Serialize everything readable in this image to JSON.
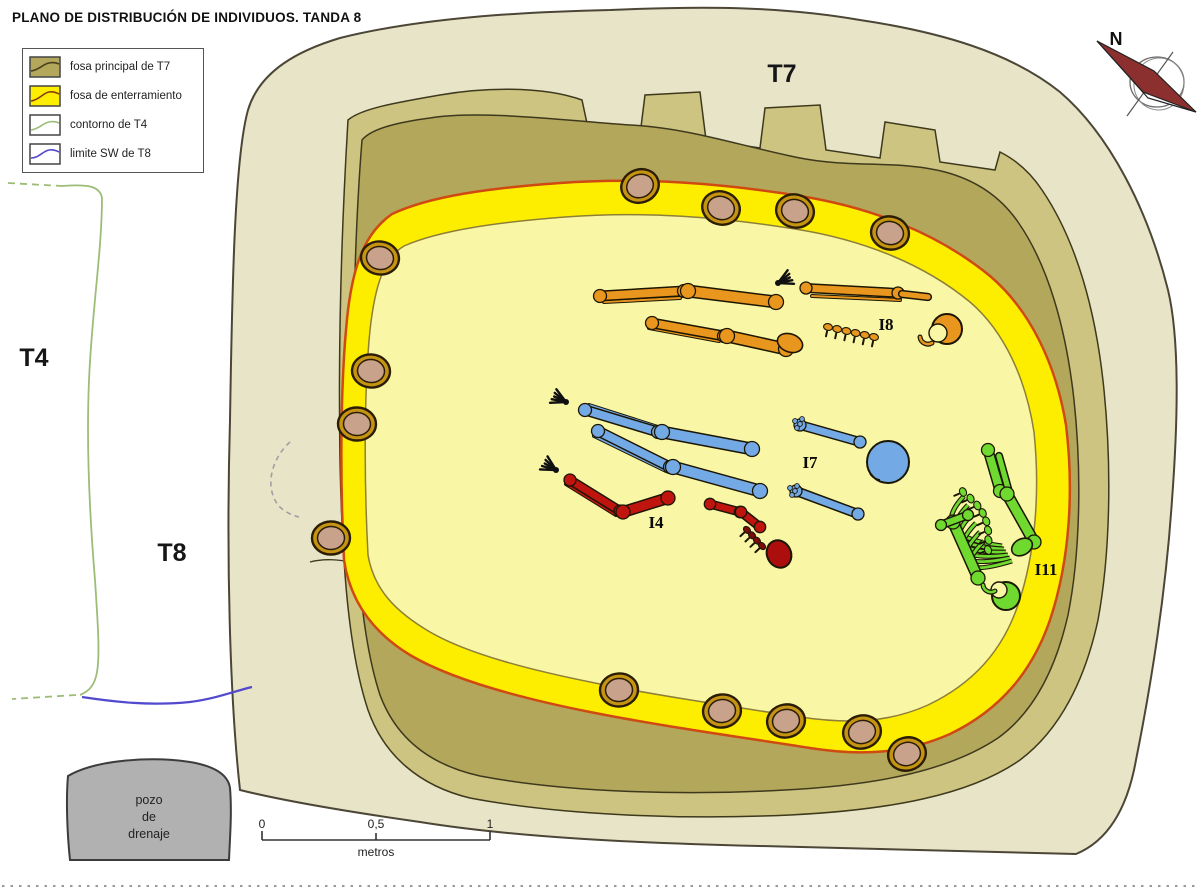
{
  "title": "PLANO DE DISTRIBUCIÓN DE INDIVIDUOS. TANDA 8",
  "legend": {
    "items": [
      {
        "label": "fosa principal de T7",
        "swatch": "olive-area"
      },
      {
        "label": "fosa de enterramiento",
        "swatch": "yellow-area"
      },
      {
        "label": "contorno de T4",
        "swatch": "green-line"
      },
      {
        "label": "limite SW de T8",
        "swatch": "blue-line"
      }
    ]
  },
  "areas": {
    "t7": "T7",
    "t4": "T4",
    "t8": "T8"
  },
  "individuals": [
    {
      "id": "I8",
      "color": "#e8961e"
    },
    {
      "id": "I7",
      "color": "#73a9e4"
    },
    {
      "id": "I4",
      "color": "#c0140f"
    },
    {
      "id": "I11",
      "color": "#6fd930"
    }
  ],
  "compass": {
    "label": "N"
  },
  "drain": {
    "label_lines": [
      "pozo",
      "de",
      "drenaje"
    ]
  },
  "scale_bar": {
    "ticks": [
      "0",
      "0,5",
      "1"
    ],
    "unit": "metros"
  },
  "colors": {
    "outer_area": "#e8e4c8",
    "fosa_principal_outer": "#cdc481",
    "fosa_principal": "#b3a75c",
    "fosa_enterramiento": "#fdee00",
    "fosa_border_red": "#cf4a10",
    "burial_floor": "#f9f7a6",
    "stone_fill": "#c8a28a",
    "stone_ring": "#c59412",
    "contorno_t4_line": "#9dbd77",
    "limite_t8_line": "#5149ce",
    "drain_fill": "#b1b1b1",
    "bone_outline": "#1c1604",
    "compass_needle": "#8c2f2f"
  }
}
